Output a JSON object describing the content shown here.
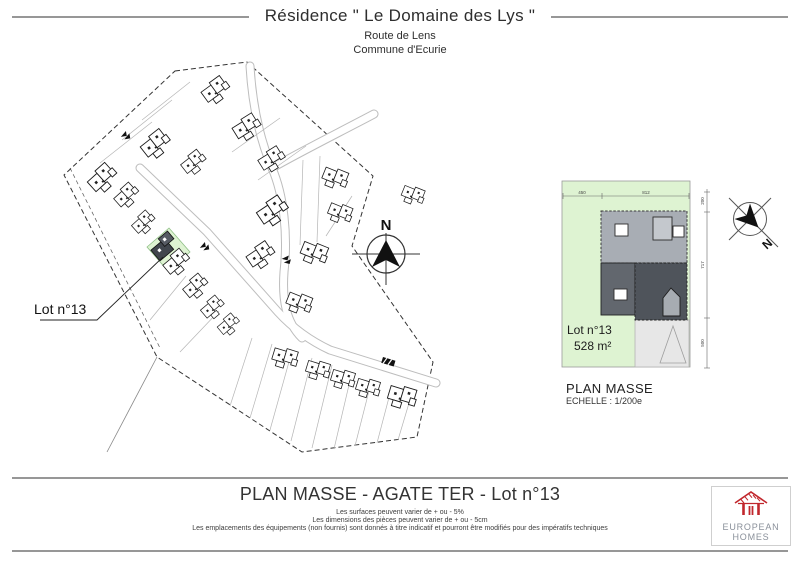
{
  "header": {
    "title": "Résidence \" Le Domaine des Lys \"",
    "subtitle1": "Route de Lens",
    "subtitle2": "Commune d'Ecurie"
  },
  "site_plan": {
    "lot_label": "Lot n°13",
    "compass_n": "N"
  },
  "detail": {
    "lot_label": "Lot n°13",
    "area": "528 m²",
    "caption_title": "PLAN MASSE",
    "caption_scale": "ECHELLE : 1/200e",
    "compass_n": "N",
    "dim_top_1": "450",
    "dim_top_2": "812",
    "dim_right_1": "200",
    "dim_right_2": "717",
    "dim_right_3": "500"
  },
  "footer": {
    "title": "PLAN MASSE - AGATE TER - Lot n°13",
    "disclaimers": [
      "Les surfaces peuvent varier de + ou - 5%",
      "Les dimensions des pièces peuvent varier de + ou - 5cm",
      "Les emplacements des équipements (non fournis) sont donnés à titre indicatif et pourront être modifiés pour des impératifs techniques"
    ],
    "logo_line1": "EUROPEAN",
    "logo_line2": "HOMES"
  },
  "colors": {
    "lot_green": "#def3d2",
    "roof_light": "#a8adb4",
    "roof_dark_left": "#62676e",
    "roof_dark_right": "#4f545b",
    "logo_red": "#c1272d",
    "rule_gray": "#979797"
  }
}
